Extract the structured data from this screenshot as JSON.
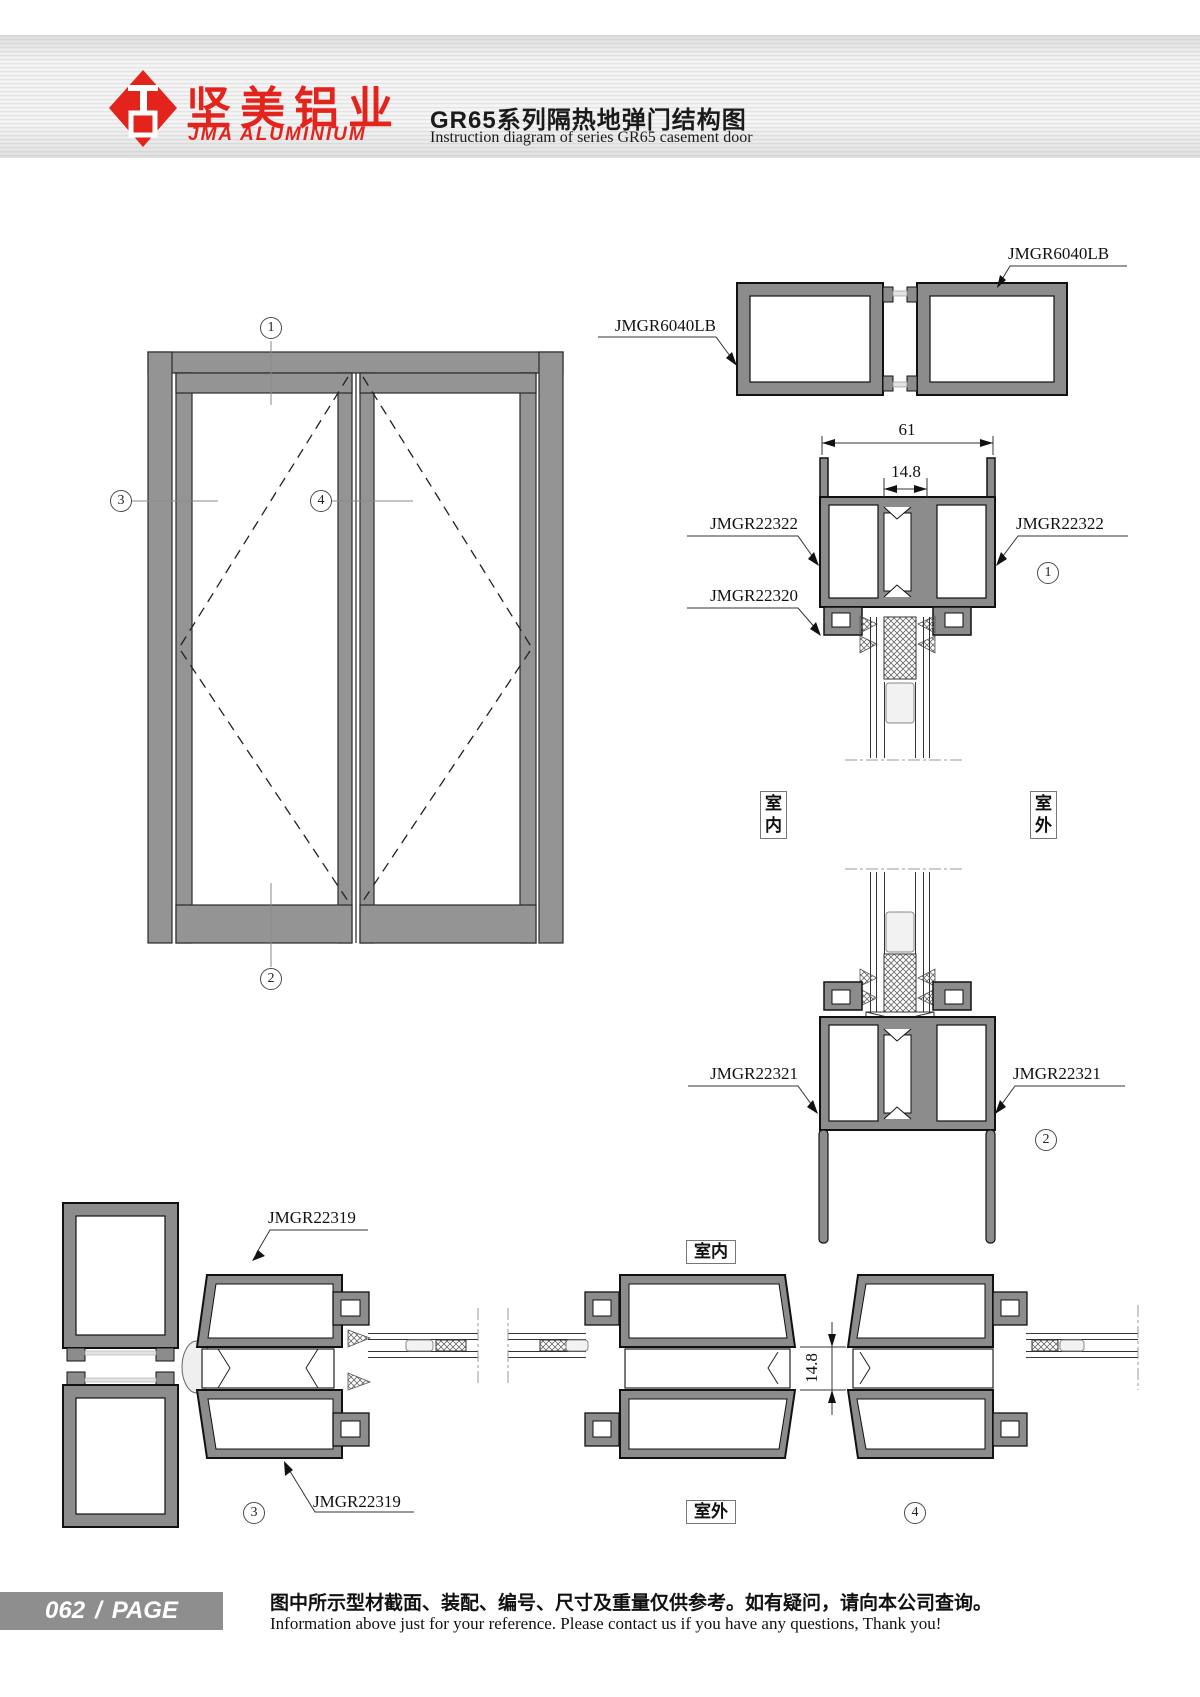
{
  "header": {
    "logo_cn": "坚美铝业",
    "logo_en": "JMA ALUMINIUM",
    "title_cn": "GR65系列隔热地弹门结构图",
    "title_en": "Instruction diagram of series GR65 casement door"
  },
  "part_labels": {
    "jmgr6040lb_left": "JMGR6040LB",
    "jmgr6040lb_right": "JMGR6040LB",
    "jmgr22322_left": "JMGR22322",
    "jmgr22322_right": "JMGR22322",
    "jmgr22320": "JMGR22320",
    "jmgr22321_left": "JMGR22321",
    "jmgr22321_right": "JMGR22321",
    "jmgr22319_top": "JMGR22319",
    "jmgr22319_bottom": "JMGR22319"
  },
  "dimensions": {
    "frame_width": "61",
    "thermal_gap_top": "14.8",
    "thermal_gap_plan": "14.8"
  },
  "location_labels": {
    "indoor_section": "室内",
    "outdoor_section": "室外",
    "indoor_plan": "室内",
    "outdoor_plan": "室外"
  },
  "callouts": {
    "n1": "1",
    "n2": "2",
    "n3": "3",
    "n4": "4"
  },
  "footer": {
    "page_number": "062",
    "separator": "/",
    "page_label": "PAGE",
    "note_cn": "图中所示型材截面、装配、编号、尺寸及重量仅供参考。如有疑问，请向本公司查询。",
    "note_en": "Information above just for your reference. Please contact us if you have any questions, Thank you!"
  }
}
